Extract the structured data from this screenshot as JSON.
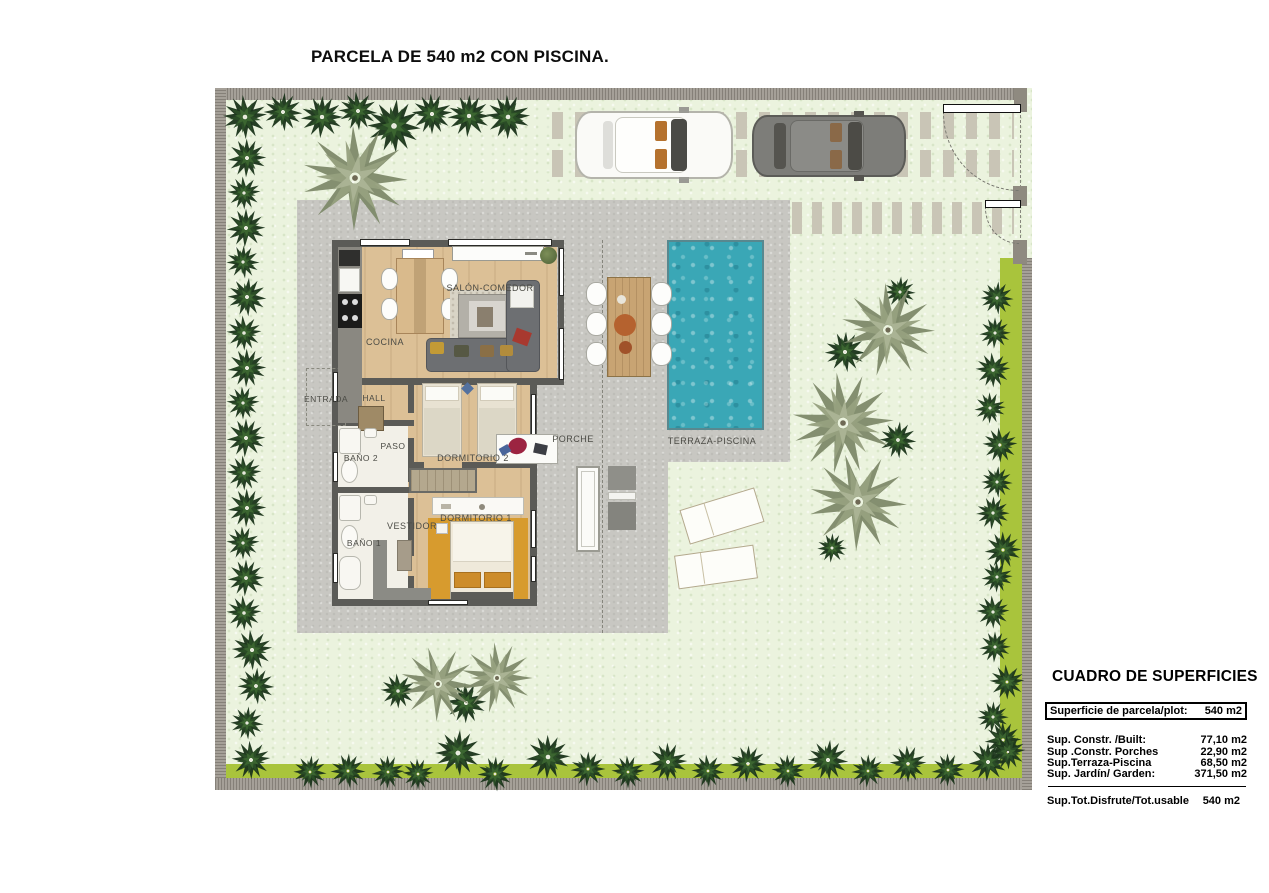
{
  "title": "PARCELA DE 540 m2 CON PISCINA.",
  "plan": {
    "rooms": {
      "salon": "SALÓN-COMEDOR",
      "cocina": "COCINA",
      "entrada": "ENTRADA",
      "hall": "HALL",
      "paso": "PASO",
      "bano2": "BAÑO 2",
      "dormitorio2": "DORMITORIO 2",
      "vestidor": "VESTIDOR",
      "bano1": "BAÑO 1",
      "dormitorio1": "DORMITORIO 1",
      "porche": "PORCHE",
      "terraza": "TERRAZA-PISCINA"
    }
  },
  "surface_table": {
    "title": "CUADRO DE SUPERFICIES",
    "plot_row": {
      "label": "Superficie de parcela/plot:",
      "value": "540 m2"
    },
    "rows": [
      {
        "label": "Sup. Constr. /Built:",
        "value": "77,10 m2"
      },
      {
        "label": "Sup .Constr. Porches",
        "value": "22,90 m2"
      },
      {
        "label": "Sup.Terraza-Piscina",
        "value": "68,50 m2"
      },
      {
        "label": "Sup. Jardín/ Garden:",
        "value": "371,50 m2"
      }
    ],
    "total_row": {
      "label": "Sup.Tot.Disfrute/Tot.usable",
      "value": "540 m2"
    }
  },
  "colors": {
    "lawn": "#ebf3de",
    "terrace": "#c8c7c2",
    "pool": "#3aa7b6",
    "wood_floor": "#dcc096",
    "wall": "#5b5b57",
    "hedge": "#a9c43c",
    "rug_orange": "#d79b2e",
    "tree_dark": [
      "#1c351c",
      "#2b4d27",
      "#3c6631"
    ],
    "tree_sage": [
      "#7f8a6b",
      "#96a07f",
      "#abb495"
    ]
  },
  "garden": {
    "trees": [
      [
        245,
        117,
        24,
        "d"
      ],
      [
        283,
        112,
        21,
        "d"
      ],
      [
        322,
        117,
        23,
        "d"
      ],
      [
        358,
        111,
        21,
        "d"
      ],
      [
        394,
        126,
        29,
        "d"
      ],
      [
        432,
        114,
        22,
        "d"
      ],
      [
        469,
        116,
        23,
        "d"
      ],
      [
        508,
        117,
        24,
        "d"
      ],
      [
        247,
        158,
        21,
        "d"
      ],
      [
        244,
        193,
        18,
        "d"
      ],
      [
        246,
        228,
        21,
        "d"
      ],
      [
        243,
        262,
        18,
        "d"
      ],
      [
        247,
        297,
        21,
        "d"
      ],
      [
        244,
        333,
        19,
        "d"
      ],
      [
        247,
        368,
        21,
        "d"
      ],
      [
        243,
        403,
        18,
        "d"
      ],
      [
        246,
        438,
        21,
        "d"
      ],
      [
        244,
        473,
        19,
        "d"
      ],
      [
        247,
        508,
        21,
        "d"
      ],
      [
        243,
        543,
        18,
        "d"
      ],
      [
        246,
        578,
        20,
        "d"
      ],
      [
        244,
        613,
        19,
        "d"
      ],
      [
        252,
        650,
        22,
        "d"
      ],
      [
        256,
        686,
        20,
        "d"
      ],
      [
        247,
        723,
        18,
        "d"
      ],
      [
        251,
        760,
        21,
        "d"
      ],
      [
        310,
        772,
        18,
        "d"
      ],
      [
        348,
        771,
        19,
        "d"
      ],
      [
        388,
        772,
        18,
        "d"
      ],
      [
        418,
        774,
        17,
        "d"
      ],
      [
        458,
        753,
        25,
        "d"
      ],
      [
        495,
        774,
        19,
        "d"
      ],
      [
        548,
        757,
        24,
        "d"
      ],
      [
        588,
        769,
        19,
        "d"
      ],
      [
        628,
        772,
        18,
        "d"
      ],
      [
        668,
        762,
        21,
        "d"
      ],
      [
        708,
        771,
        18,
        "d"
      ],
      [
        748,
        764,
        20,
        "d"
      ],
      [
        788,
        771,
        18,
        "d"
      ],
      [
        828,
        760,
        22,
        "d"
      ],
      [
        868,
        771,
        18,
        "d"
      ],
      [
        908,
        764,
        20,
        "d"
      ],
      [
        948,
        770,
        18,
        "d"
      ],
      [
        988,
        762,
        21,
        "d"
      ],
      [
        1003,
        740,
        20,
        "d"
      ],
      [
        997,
        298,
        18,
        "d"
      ],
      [
        995,
        333,
        17,
        "d"
      ],
      [
        993,
        370,
        19,
        "d"
      ],
      [
        990,
        408,
        17,
        "d"
      ],
      [
        1000,
        445,
        19,
        "d"
      ],
      [
        997,
        482,
        17,
        "d"
      ],
      [
        993,
        513,
        18,
        "d"
      ],
      [
        1003,
        550,
        20,
        "d"
      ],
      [
        997,
        577,
        17,
        "d"
      ],
      [
        993,
        612,
        18,
        "d"
      ],
      [
        995,
        647,
        17,
        "d"
      ],
      [
        1007,
        682,
        19,
        "d"
      ],
      [
        993,
        717,
        17,
        "d"
      ],
      [
        1008,
        752,
        19,
        "d"
      ],
      [
        900,
        292,
        17,
        "d"
      ],
      [
        845,
        352,
        22,
        "d"
      ],
      [
        898,
        440,
        20,
        "d"
      ],
      [
        832,
        548,
        16,
        "d"
      ],
      [
        398,
        691,
        19,
        "d"
      ],
      [
        466,
        703,
        22,
        "d"
      ],
      [
        355,
        178,
        56,
        "s"
      ],
      [
        888,
        330,
        50,
        "s"
      ],
      [
        843,
        423,
        54,
        "s"
      ],
      [
        858,
        502,
        52,
        "s"
      ],
      [
        438,
        684,
        40,
        "s"
      ],
      [
        497,
        678,
        38,
        "s"
      ]
    ]
  }
}
